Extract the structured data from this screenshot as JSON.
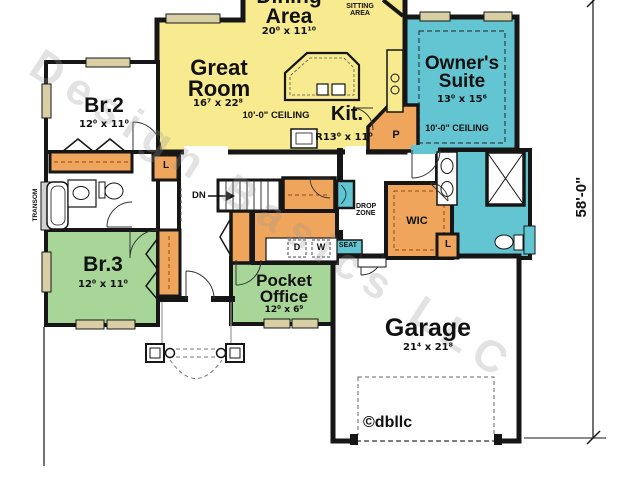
{
  "watermark": {
    "text": "Design Basics LLC",
    "copyright": "©dbllc"
  },
  "dimensions": {
    "right_overall": "58'-0\""
  },
  "rooms": {
    "dining": {
      "name": "Dining\nArea",
      "dims": "20⁰ x 11¹⁰"
    },
    "sitting": {
      "name": "SITTING\nAREA"
    },
    "great": {
      "name": "Great\nRoom",
      "dims": "16⁷ x 22⁸",
      "ceiling": "10'-0\" CEILING"
    },
    "kitchen": {
      "name": "Kit.",
      "dims": "R13⁰ x 11⁰"
    },
    "suite": {
      "name": "Owner's\nSuite",
      "dims": "13⁰ x 15⁶",
      "ceiling": "10'-0\" CEILING"
    },
    "br2": {
      "name": "Br.2",
      "dims": "12⁰ x 11⁰"
    },
    "br3": {
      "name": "Br.3",
      "dims": "12⁰ x 11⁰"
    },
    "office": {
      "name": "Pocket\nOffice",
      "dims": "12⁰ x 6⁹"
    },
    "garage": {
      "name": "Garage",
      "dims": "21⁴ x 21⁸"
    }
  },
  "labels": {
    "dn": "DN",
    "drop_zone": "DROP\nZONE",
    "wic": "WIC",
    "linen": "L",
    "pantry": "P",
    "dryer": "D",
    "washer": "W",
    "seat": "SEAT",
    "transom": "TRANSOM"
  },
  "colors": {
    "yellow": "#f7ea8f",
    "cyan": "#63c5d1",
    "green": "#a8d698",
    "orange": "#f0a55c",
    "window": "#d9cfa5",
    "wall": "#161616"
  }
}
